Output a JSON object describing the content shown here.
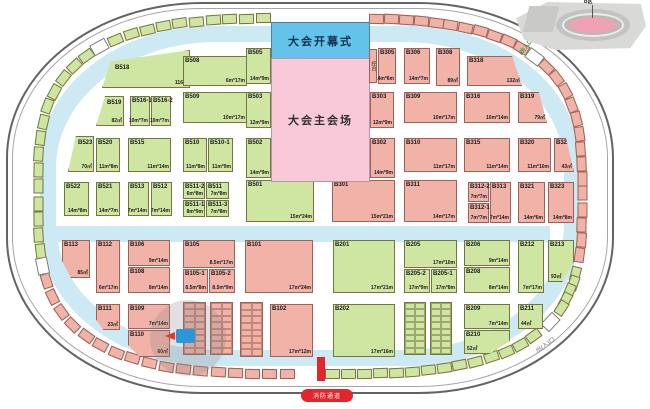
{
  "labels": {
    "opening": "大会开幕式",
    "main_venue": "大会主会场",
    "console": "控台",
    "fire_lane": "消防通道",
    "exit_bottom_right": "出(入)口",
    "entrance_top_right": "(出入口)",
    "inset": "B区"
  },
  "colors": {
    "booth_green": "#cfe6a3",
    "booth_pink": "#f1b3a7",
    "corridor_blue": "#cde9f4",
    "opening_blue": "#63c3e9",
    "venue_pink": "#f8c9d8",
    "accent_red": "#e2262c",
    "wall_grey": "#636363"
  },
  "booths": [
    {
      "id": "B518",
      "dim": "116㎡",
      "x": 102,
      "y": 50,
      "w": 88,
      "h": 38,
      "c": "g",
      "clip": "polygon(0 100%,10% 30%,100% 0,100% 100%)",
      "ix": 12,
      "iy": 14
    },
    {
      "id": "B508",
      "dim": "6m*17m",
      "x": 183,
      "y": 56,
      "w": 64,
      "h": 30,
      "c": "g"
    },
    {
      "id": "B505",
      "dim": "14m*9m",
      "x": 246,
      "y": 48,
      "w": 25,
      "h": 36,
      "c": "g"
    },
    {
      "id": "B519",
      "dim": "82㎡",
      "x": 96,
      "y": 96,
      "w": 28,
      "h": 30,
      "c": "g",
      "clip": "polygon(32% 0,100% 0,100% 100%,0 100%)",
      "ix": 10,
      "iy": 3
    },
    {
      "id": "B516-1",
      "dim": "10m*7m",
      "x": 130,
      "y": 96,
      "w": 20,
      "h": 30,
      "c": "g"
    },
    {
      "id": "B516-2",
      "dim": "10m*7m",
      "x": 151,
      "y": 96,
      "w": 20,
      "h": 30,
      "c": "g"
    },
    {
      "id": "B509",
      "dim": "10m*17m",
      "x": 183,
      "y": 92,
      "w": 64,
      "h": 31,
      "c": "g"
    },
    {
      "id": "B503",
      "dim": "12m*9m",
      "x": 246,
      "y": 92,
      "w": 25,
      "h": 36,
      "c": "g"
    },
    {
      "id": "B523",
      "dim": "70㎡",
      "x": 68,
      "y": 136,
      "w": 26,
      "h": 36,
      "c": "g",
      "clip": "polygon(30% 0,100% 0,100% 100%,0 100%)",
      "ix": 9,
      "iy": 3
    },
    {
      "id": "B520",
      "dim": "11m*8m",
      "x": 96,
      "y": 138,
      "w": 24,
      "h": 34,
      "c": "g"
    },
    {
      "id": "B515",
      "dim": "11m*14m",
      "x": 128,
      "y": 138,
      "w": 43,
      "h": 34,
      "c": "g"
    },
    {
      "id": "B510",
      "dim": "11m*8m",
      "x": 183,
      "y": 138,
      "w": 24,
      "h": 34,
      "c": "g"
    },
    {
      "id": "B510-1",
      "dim": "11m*9m",
      "x": 208,
      "y": 138,
      "w": 25,
      "h": 34,
      "c": "g"
    },
    {
      "id": "B502",
      "dim": "14m*9m",
      "x": 246,
      "y": 138,
      "w": 25,
      "h": 40,
      "c": "g"
    },
    {
      "id": "B522",
      "dim": "14m*8m",
      "x": 64,
      "y": 182,
      "w": 25,
      "h": 34,
      "c": "g"
    },
    {
      "id": "B521",
      "dim": "14m*7m",
      "x": 96,
      "y": 182,
      "w": 24,
      "h": 34,
      "c": "g"
    },
    {
      "id": "B513",
      "dim": "7m*14m",
      "x": 128,
      "y": 182,
      "w": 21,
      "h": 34,
      "c": "g"
    },
    {
      "id": "B512",
      "dim": "7m*14m",
      "x": 151,
      "y": 182,
      "w": 21,
      "h": 34,
      "c": "g"
    },
    {
      "id": "B511-2",
      "dim": "6m*8m",
      "x": 183,
      "y": 182,
      "w": 22,
      "h": 17,
      "c": "g"
    },
    {
      "id": "B511",
      "dim": "7m*8m",
      "x": 206,
      "y": 182,
      "w": 23,
      "h": 17,
      "c": "g"
    },
    {
      "id": "B511-1",
      "dim": "8m*9m",
      "x": 183,
      "y": 200,
      "w": 22,
      "h": 17,
      "c": "g"
    },
    {
      "id": "B511-3",
      "dim": "7m*8m",
      "x": 206,
      "y": 200,
      "w": 23,
      "h": 17,
      "c": "g"
    },
    {
      "id": "B501",
      "dim": "15m*24m",
      "x": 246,
      "y": 180,
      "w": 68,
      "h": 42,
      "c": "g"
    },
    {
      "id": "B305",
      "dim": "14m*6m",
      "x": 378,
      "y": 48,
      "w": 18,
      "h": 36,
      "c": "p"
    },
    {
      "id": "B306",
      "dim": "14m*7m",
      "x": 404,
      "y": 48,
      "w": 26,
      "h": 36,
      "c": "p"
    },
    {
      "id": "B308",
      "dim": "89㎡",
      "x": 436,
      "y": 48,
      "w": 24,
      "h": 38,
      "c": "p"
    },
    {
      "id": "B318",
      "dim": "132㎡",
      "x": 467,
      "y": 56,
      "w": 55,
      "h": 30,
      "c": "p",
      "clip": "polygon(0 0,82% 0,100% 100%,0 100%)"
    },
    {
      "id": "B303",
      "dim": "12m*9m",
      "x": 370,
      "y": 92,
      "w": 24,
      "h": 36,
      "c": "p"
    },
    {
      "id": "B309",
      "dim": "10m*17m",
      "x": 404,
      "y": 92,
      "w": 53,
      "h": 31,
      "c": "p"
    },
    {
      "id": "B316",
      "dim": "10m*14m",
      "x": 464,
      "y": 92,
      "w": 46,
      "h": 31,
      "c": "p"
    },
    {
      "id": "B319",
      "dim": "79㎡",
      "x": 518,
      "y": 92,
      "w": 29,
      "h": 31,
      "c": "p",
      "clip": "polygon(0 0,72% 0,100% 100%,0 100%)"
    },
    {
      "id": "B302",
      "dim": "14m*9m",
      "x": 370,
      "y": 138,
      "w": 25,
      "h": 40,
      "c": "p"
    },
    {
      "id": "B310",
      "dim": "11m*17m",
      "x": 404,
      "y": 138,
      "w": 53,
      "h": 34,
      "c": "p"
    },
    {
      "id": "B315",
      "dim": "11m*14m",
      "x": 464,
      "y": 138,
      "w": 46,
      "h": 34,
      "c": "p"
    },
    {
      "id": "B320",
      "dim": "11m*10m",
      "x": 518,
      "y": 138,
      "w": 33,
      "h": 34,
      "c": "p"
    },
    {
      "id": "B322",
      "dim": "43㎡",
      "x": 554,
      "y": 138,
      "w": 20,
      "h": 34,
      "c": "p",
      "clip": "polygon(0 0,60% 0,100% 100%,0 100%)"
    },
    {
      "id": "B301",
      "dim": "15m*21m",
      "x": 332,
      "y": 180,
      "w": 63,
      "h": 42,
      "c": "p"
    },
    {
      "id": "B311",
      "dim": "14m*17m",
      "x": 404,
      "y": 180,
      "w": 53,
      "h": 42,
      "c": "p"
    },
    {
      "id": "B312-2",
      "dim": "7m*7m",
      "x": 468,
      "y": 182,
      "w": 21,
      "h": 20,
      "c": "p"
    },
    {
      "id": "B312-1",
      "dim": "7m*7m",
      "x": 468,
      "y": 203,
      "w": 21,
      "h": 20,
      "c": "p"
    },
    {
      "id": "B313",
      "dim": "7m*14m",
      "x": 490,
      "y": 182,
      "w": 21,
      "h": 41,
      "c": "p"
    },
    {
      "id": "B321",
      "dim": "14m*6m",
      "x": 518,
      "y": 182,
      "w": 27,
      "h": 41,
      "c": "p"
    },
    {
      "id": "B323",
      "dim": "14m*8m",
      "x": 548,
      "y": 182,
      "w": 26,
      "h": 41,
      "c": "p"
    },
    {
      "id": "B113",
      "dim": "85㎡",
      "x": 62,
      "y": 240,
      "w": 28,
      "h": 38,
      "c": "p",
      "clip": "polygon(0 0,100% 0,100% 100%,32% 100%,0 55%)"
    },
    {
      "id": "B112",
      "dim": "6m*17m",
      "x": 96,
      "y": 240,
      "w": 24,
      "h": 53,
      "c": "p"
    },
    {
      "id": "B106",
      "dim": "9m*14m",
      "x": 128,
      "y": 240,
      "w": 42,
      "h": 26,
      "c": "p"
    },
    {
      "id": "B108",
      "dim": "8m*14m",
      "x": 128,
      "y": 267,
      "w": 42,
      "h": 26,
      "c": "p"
    },
    {
      "id": "B105",
      "dim": "8.5m*17m",
      "x": 183,
      "y": 240,
      "w": 52,
      "h": 28,
      "c": "p"
    },
    {
      "id": "B105-1",
      "dim": "8.5m*8m",
      "x": 183,
      "y": 269,
      "w": 25,
      "h": 24,
      "c": "p"
    },
    {
      "id": "B105-2",
      "dim": "8.5m*9m",
      "x": 209,
      "y": 269,
      "w": 26,
      "h": 24,
      "c": "p"
    },
    {
      "id": "B101",
      "dim": "17m*24m",
      "x": 245,
      "y": 240,
      "w": 68,
      "h": 53,
      "c": "p"
    },
    {
      "id": "B111",
      "dim": "23㎡",
      "x": 96,
      "y": 304,
      "w": 24,
      "h": 26,
      "c": "p",
      "clip": "polygon(0 0,100% 0,100% 100%,30% 100%,0 60%)"
    },
    {
      "id": "B109",
      "dim": "7m*14m",
      "x": 128,
      "y": 304,
      "w": 42,
      "h": 25,
      "c": "p"
    },
    {
      "id": "B110",
      "dim": "60㎡",
      "x": 128,
      "y": 330,
      "w": 42,
      "h": 27,
      "c": "p",
      "clip": "polygon(0 0,100% 0,100% 100%,28% 100%,0 55%)"
    },
    {
      "id": "B102",
      "dim": "17m*12m",
      "x": 270,
      "y": 304,
      "w": 43,
      "h": 53,
      "c": "p"
    },
    {
      "id": "B201",
      "dim": "17m*21m",
      "x": 333,
      "y": 240,
      "w": 62,
      "h": 53,
      "c": "g"
    },
    {
      "id": "B205",
      "dim": "17m*10m",
      "x": 404,
      "y": 240,
      "w": 53,
      "h": 28,
      "c": "g"
    },
    {
      "id": "B205-2",
      "dim": "17m*9m",
      "x": 404,
      "y": 269,
      "w": 26,
      "h": 24,
      "c": "g"
    },
    {
      "id": "B205-1",
      "dim": "17m*8m",
      "x": 431,
      "y": 269,
      "w": 26,
      "h": 24,
      "c": "g"
    },
    {
      "id": "B206",
      "dim": "9m*14m",
      "x": 464,
      "y": 240,
      "w": 46,
      "h": 26,
      "c": "g"
    },
    {
      "id": "B208",
      "dim": "8m*14m",
      "x": 464,
      "y": 267,
      "w": 46,
      "h": 26,
      "c": "g"
    },
    {
      "id": "B212",
      "dim": "7m*17m",
      "x": 518,
      "y": 240,
      "w": 26,
      "h": 53,
      "c": "g"
    },
    {
      "id": "B213",
      "dim": "93㎡",
      "x": 548,
      "y": 240,
      "w": 26,
      "h": 42,
      "c": "g",
      "clip": "polygon(0 0,100% 0,100% 52%,55% 100%,0 100%)",
      "dpos": "bl"
    },
    {
      "id": "B202",
      "dim": "17m*16m",
      "x": 333,
      "y": 304,
      "w": 62,
      "h": 53,
      "c": "g"
    },
    {
      "id": "B209",
      "dim": "7m*14m",
      "x": 464,
      "y": 304,
      "w": 46,
      "h": 25,
      "c": "g"
    },
    {
      "id": "B210",
      "dim": "52㎡",
      "x": 464,
      "y": 330,
      "w": 46,
      "h": 24,
      "c": "g",
      "clip": "polygon(0 0,100% 0,100% 45%,55% 100%,0 100%)",
      "dpos": "bl"
    },
    {
      "id": "B211",
      "dim": "44㎡",
      "x": 518,
      "y": 304,
      "w": 25,
      "h": 25,
      "c": "g",
      "dpos": "bl"
    }
  ],
  "strips": [
    {
      "x": 183,
      "y": 302,
      "w": 23,
      "h": 53,
      "c": "p"
    },
    {
      "x": 210,
      "y": 302,
      "w": 23,
      "h": 53,
      "c": "p"
    },
    {
      "x": 240,
      "y": 302,
      "w": 23,
      "h": 55,
      "c": "p"
    },
    {
      "x": 404,
      "y": 302,
      "w": 22,
      "h": 53,
      "c": "g"
    },
    {
      "x": 430,
      "y": 302,
      "w": 22,
      "h": 53,
      "c": "g"
    }
  ],
  "rim": {
    "cx": 310,
    "cy": 196,
    "rx": 272,
    "ry": 178,
    "n": 3.2,
    "cw": 15,
    "ch": 10,
    "segments": [
      {
        "from": 90.6,
        "to": 165,
        "count": 17,
        "c": "p"
      },
      {
        "from": 169,
        "to": 226,
        "count": 14,
        "c": "g"
      },
      {
        "from": 231.5,
        "to": 267.4,
        "count": 10,
        "c": "g"
      },
      {
        "from": 274.8,
        "to": 314.5,
        "count": 11,
        "c": "p"
      },
      {
        "from": 320.5,
        "to": 372,
        "count": 14,
        "c": "p"
      },
      {
        "from": 374,
        "to": 390,
        "count": 5,
        "c": "g"
      },
      {
        "from": 400,
        "to": 449.4,
        "count": 14,
        "c": "g"
      }
    ],
    "gates": [
      228.6,
      317.5,
      395,
      167
    ]
  }
}
